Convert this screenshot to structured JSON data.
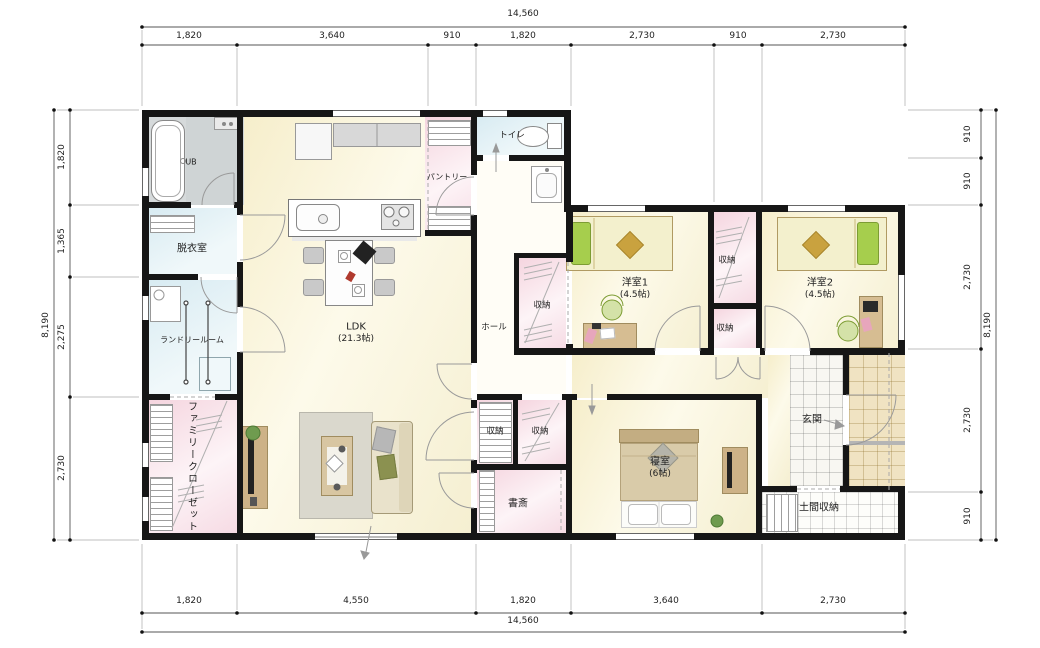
{
  "dimensions": {
    "top": {
      "total": "14,560",
      "segments": [
        "1,820",
        "3,640",
        "910",
        "1,820",
        "2,730",
        "910",
        "2,730"
      ]
    },
    "bottom": {
      "total": "14,560",
      "segments": [
        "1,820",
        "4,550",
        "1,820",
        "3,640",
        "2,730"
      ]
    },
    "left": {
      "total": "8,190",
      "segments": [
        "1,820",
        "1,365",
        "2,275",
        "2,730"
      ]
    },
    "right": {
      "total": "8,190",
      "segments": [
        "910",
        "910",
        "2,730",
        "2,730",
        "910"
      ]
    }
  },
  "rooms": {
    "ub": "UB",
    "dressing": "脱衣室",
    "laundry": "ランドリールーム",
    "family_closet": "ファミリークローゼット",
    "ldk": "LDK",
    "ldk_size": "(21.3帖)",
    "pantry": "パントリー",
    "toilet": "トイレ",
    "hall": "ホール",
    "storage": "収納",
    "bedroom1": "洋室1",
    "bedroom1_size": "(4.5帖)",
    "bedroom2": "洋室2",
    "bedroom2_size": "(4.5帖)",
    "entrance": "玄関",
    "entrance_storage": "土間収納",
    "master": "寝室",
    "master_size": "(6帖)",
    "study": "書斎"
  },
  "colors": {
    "wall": "#161616",
    "floor_wood": "#f9f3d8",
    "floor_pink": "#f6d9e2",
    "floor_blue": "#ddedf3",
    "floor_bath": "#d6dadb",
    "porch_tile": "#f0e3c2",
    "tatami_green": "#a6ce4d"
  }
}
